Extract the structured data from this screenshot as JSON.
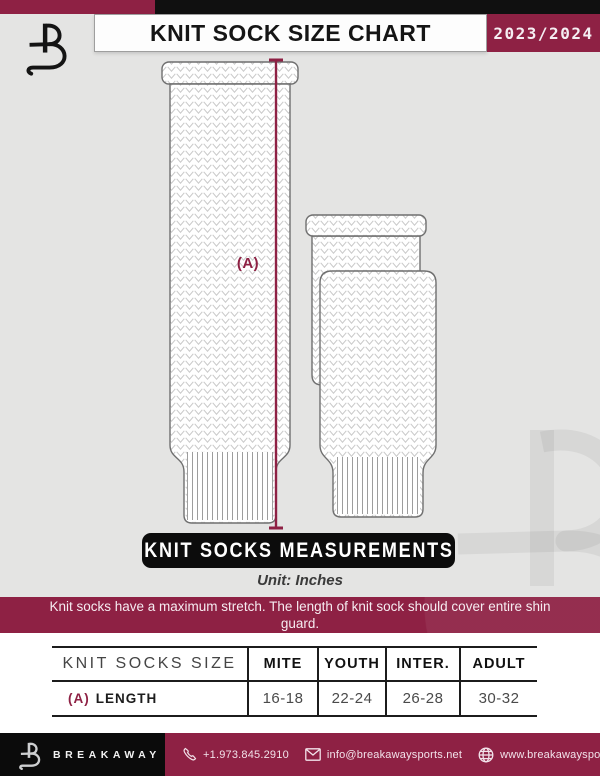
{
  "colors": {
    "maroon": "#8e2144",
    "black": "#101010",
    "page_gray": "#e4e4e3",
    "table_line": "#1c1c1c"
  },
  "header": {
    "title": "KNIT SOCK SIZE CHART",
    "season": "2023/2024",
    "logo": "breakaway-b-logo"
  },
  "diagram": {
    "measure_label": "(A)",
    "banner": "KNIT SOCKS MEASUREMENTS",
    "unit": "Unit: Inches"
  },
  "notice": {
    "text": "Knit socks have a maximum stretch. The length of knit sock should cover entire shin guard."
  },
  "table": {
    "title": "KNIT SOCKS SIZE",
    "columns": [
      "MITE",
      "YOUTH",
      "INTER.",
      "ADULT"
    ],
    "rows": [
      {
        "key": "(A)",
        "label": "LENGTH",
        "values": [
          "16-18",
          "22-24",
          "26-28",
          "30-32"
        ]
      }
    ]
  },
  "footer": {
    "brand": "BREAKAWAY",
    "phone": "+1.973.845.2910",
    "email": "info@breakawaysports.net",
    "website": "www.breakawaysports.net"
  }
}
